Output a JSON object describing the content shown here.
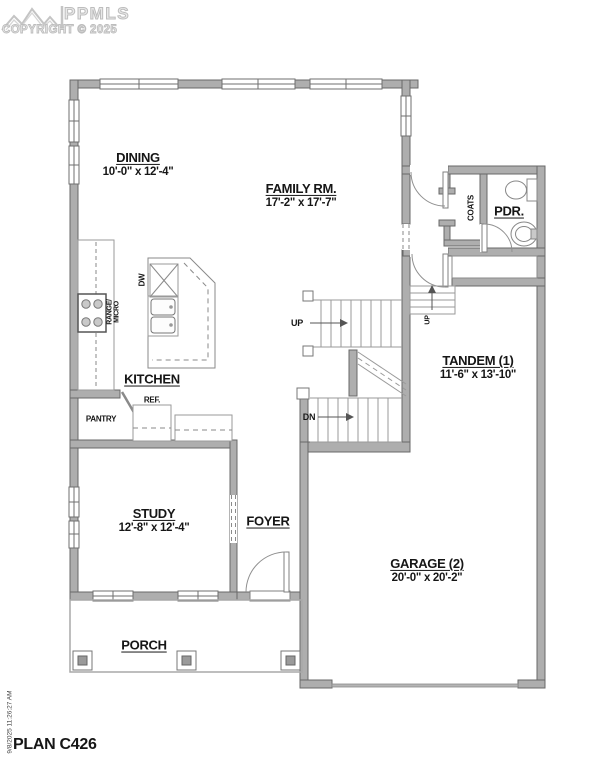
{
  "header": {
    "logo_text": "PPMLS",
    "copyright": "COPYRIGHT © 2025"
  },
  "rooms": {
    "dining": {
      "name": "DINING",
      "dims": "10'-0\" x 12'-4\""
    },
    "family": {
      "name": "FAMILY RM.",
      "dims": "17'-2\" x 17'-7\""
    },
    "pdr": {
      "name": "PDR."
    },
    "kitchen": {
      "name": "KITCHEN"
    },
    "tandem": {
      "name": "TANDEM (1)",
      "dims": "11'-6\" x 13'-10\""
    },
    "study": {
      "name": "STUDY",
      "dims": "12'-8\" x 12'-4\""
    },
    "foyer": {
      "name": "FOYER"
    },
    "garage": {
      "name": "GARAGE (2)",
      "dims": "20'-0\" x 20'-2\""
    },
    "porch": {
      "name": "PORCH"
    }
  },
  "labels": {
    "coats": "COATS",
    "pantry": "PANTRY",
    "ref": "REF.",
    "dw": "DW",
    "range1": "RANGE/",
    "range2": "MICRO",
    "up_main": "UP",
    "dn_main": "DN",
    "up_garage": "UP"
  },
  "footer": {
    "plan_label": "PLAN C426",
    "timestamp": "9/8/2025 11:26:27 AM"
  },
  "colors": {
    "wall_fill": "#aeaeae",
    "wall_outline": "#686868",
    "thin_line": "#909090",
    "text": "#161616",
    "logo": "#bdbdbd"
  }
}
